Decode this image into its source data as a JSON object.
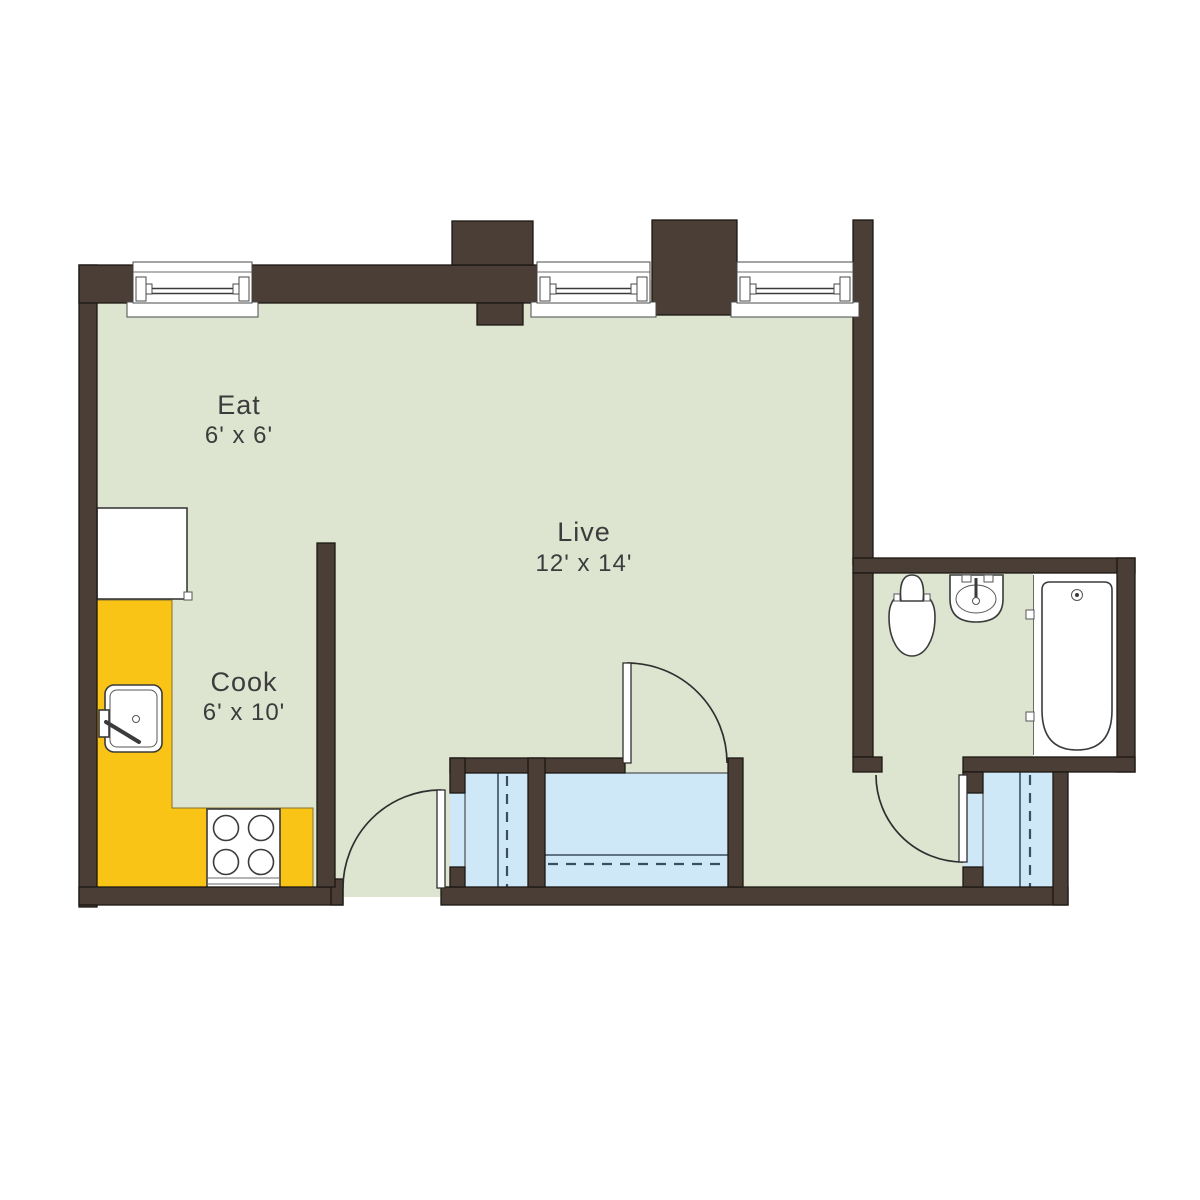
{
  "plan": {
    "rooms": [
      {
        "name": "Eat",
        "dims": "6' x 6'"
      },
      {
        "name": "Live",
        "dims": "12' x 14'"
      },
      {
        "name": "Cook",
        "dims": "6' x 10'"
      }
    ],
    "fixtures": [
      "refrigerator",
      "kitchen-sink",
      "stove",
      "toilet",
      "bathroom-sink",
      "bathtub"
    ],
    "colors": {
      "wall": "#4a3e36",
      "floor": "#dde5d1",
      "counter": "#f9c415",
      "closet": "#cfe8f8",
      "text": "#3c3c3c"
    }
  }
}
